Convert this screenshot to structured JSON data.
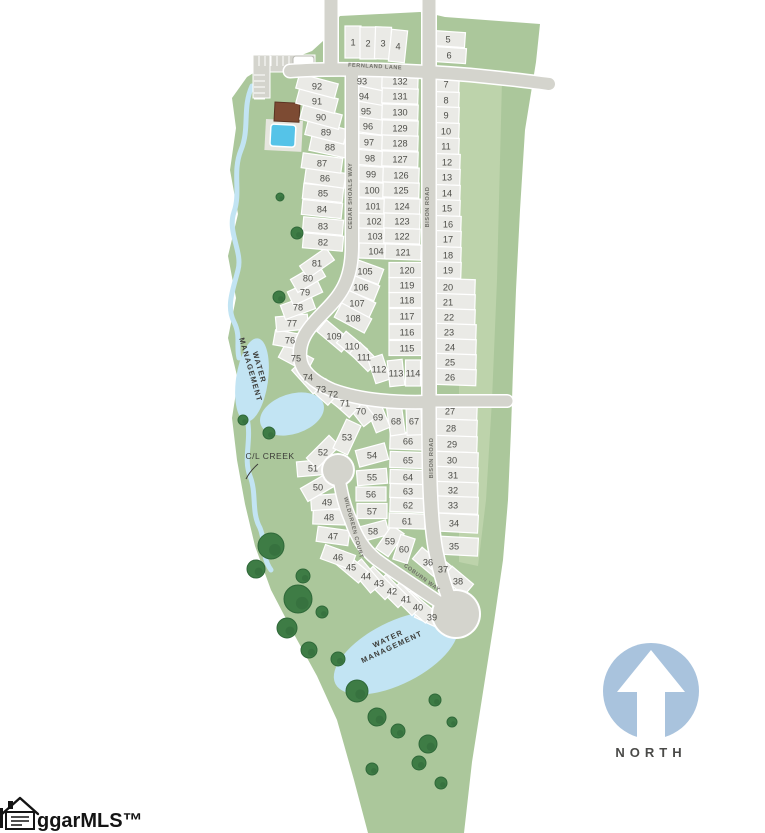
{
  "north": {
    "label": "NORTH"
  },
  "logo": {
    "text": "ggarMLS™"
  },
  "colors": {
    "green": "#abc79b",
    "greenLight": "#bdd3ab",
    "road": "#d4d4cd",
    "lot": "#eaeae6",
    "water": "#c2e4f3",
    "pool": "#55c3e8",
    "tree": "#3e7c45",
    "treeEdge": "#2f6839",
    "northBlue": "#a9c3dd",
    "numText": "#4d4d48",
    "labelText": "#6f6f68",
    "darkText": "#3c3c38",
    "roof": "#7d4b33",
    "deck": "#e6e6df"
  },
  "map": {
    "green_outline": [
      [
        340,
        16
      ],
      [
        420,
        12
      ],
      [
        432,
        14
      ],
      [
        445,
        17
      ],
      [
        540,
        24
      ],
      [
        536,
        62
      ],
      [
        525,
        130
      ],
      [
        520,
        210
      ],
      [
        516,
        290
      ],
      [
        513,
        370
      ],
      [
        511,
        430
      ],
      [
        508,
        500
      ],
      [
        503,
        560
      ],
      [
        494,
        622
      ],
      [
        483,
        692
      ],
      [
        472,
        762
      ],
      [
        464,
        833
      ],
      [
        368,
        833
      ],
      [
        354,
        780
      ],
      [
        337,
        720
      ],
      [
        317,
        676
      ],
      [
        295,
        636
      ],
      [
        271,
        590
      ],
      [
        255,
        546
      ],
      [
        245,
        504
      ],
      [
        237,
        460
      ],
      [
        232,
        418
      ],
      [
        238,
        380
      ],
      [
        228,
        338
      ],
      [
        236,
        298
      ],
      [
        228,
        256
      ],
      [
        238,
        214
      ],
      [
        230,
        170
      ],
      [
        236,
        128
      ],
      [
        232,
        98
      ],
      [
        247,
        77
      ],
      [
        268,
        64
      ],
      [
        294,
        58
      ],
      [
        312,
        51
      ],
      [
        323,
        41
      ],
      [
        331,
        27
      ]
    ],
    "green_light_strip": [
      [
        459,
        76
      ],
      [
        502,
        80
      ],
      [
        497,
        280
      ],
      [
        492,
        400
      ],
      [
        486,
        500
      ],
      [
        478,
        566
      ],
      [
        459,
        562
      ]
    ],
    "creek_paths": [
      "M252,86 C242,108 250,128 241,150 C232,172 241,192 234,212 C227,232 243,252 238,270 C233,290 226,306 234,322 C241,336 236,346 239,358",
      "M247,418 C252,440 243,458 250,476 C257,494 251,512 260,528 C266,542 261,556 271,570"
    ],
    "creek_label": {
      "text": "C/L CREEK",
      "x": 270,
      "y": 459,
      "leader": "M258,464 Q250,471 246,479"
    },
    "ponds": [
      {
        "cx": 252,
        "cy": 380,
        "rx": 16,
        "ry": 42,
        "rot": 8
      },
      {
        "cx": 292,
        "cy": 414,
        "rx": 33,
        "ry": 20,
        "rot": -18
      },
      {
        "cx": 396,
        "cy": 653,
        "rx": 68,
        "ry": 31,
        "rot": -27
      }
    ],
    "water_labels": [
      {
        "lines": [
          "WATER",
          "MANAGEMENT"
        ],
        "x": 257,
        "y": 368,
        "r": 74
      },
      {
        "lines": [
          "WATER",
          "MANAGEMENT"
        ],
        "x": 389,
        "y": 641,
        "r": -25
      }
    ],
    "roads": [
      {
        "name": "entry-north",
        "path": "M331,0 L331,68",
        "w": 13
      },
      {
        "name": "fernland-lane",
        "path": "M290,71 C340,67 420,71 470,75 C500,78 528,81 549,84",
        "w": 12
      },
      {
        "name": "bison-road",
        "path": "M429,0 L429,401",
        "w": 13
      },
      {
        "name": "bison-road-south",
        "path": "M429,401 C429,470 430,522 436,552 C441,576 446,592 451,602",
        "w": 13
      },
      {
        "name": "east-stub",
        "path": "M430,401 L507,401",
        "w": 11
      },
      {
        "name": "cedar-shoals-way",
        "path": "M352,74 L352,246 C352,282 340,296 322,314 C305,331 299,342 300,357 C301,371 312,381 332,390 C362,401 396,403 429,402",
        "w": 12
      },
      {
        "name": "wildgreen-court",
        "path": "M338,470 C341,494 345,507 351,521 C357,538 364,549 376,559 C392,571 414,585 436,600 C443,605 449,609 452,612",
        "w": 11
      }
    ],
    "culdesacs": [
      {
        "cx": 338,
        "cy": 470,
        "r": 15
      },
      {
        "cx": 456,
        "cy": 614,
        "r": 23
      }
    ],
    "street_labels": [
      {
        "text": "FERNLAND LANE",
        "x": 375,
        "y": 68,
        "r": 3
      },
      {
        "text": "CEDAR SHOALS WAY",
        "x": 352,
        "y": 196,
        "r": -90
      },
      {
        "text": "BISON ROAD",
        "x": 429,
        "y": 207,
        "r": -90
      },
      {
        "text": "BISON ROAD",
        "x": 433,
        "y": 458,
        "r": -90
      },
      {
        "text": "WILDGREEN COURT",
        "x": 352,
        "y": 528,
        "r": 75
      },
      {
        "text": "COBURN WAY",
        "x": 421,
        "y": 579,
        "r": 36
      }
    ],
    "amenity": {
      "parking": {
        "x": 253,
        "y": 55,
        "wTop": 62,
        "hTop": 17,
        "wSide": 17,
        "hSide": 43
      },
      "sign": {
        "x": 293,
        "y": 56,
        "w": 21,
        "h": 10
      },
      "clubhouse": {
        "x": 275,
        "y": 102,
        "w": 25,
        "h": 19
      },
      "pool_deck": {
        "x": 266,
        "y": 119,
        "w": 37,
        "h": 31
      },
      "pool": {
        "x": 271,
        "y": 124,
        "w": 25,
        "h": 22
      }
    },
    "trees": [
      [
        297,
        233,
        6
      ],
      [
        279,
        297,
        6
      ],
      [
        243,
        420,
        5
      ],
      [
        269,
        433,
        6
      ],
      [
        280,
        197,
        4
      ],
      [
        271,
        546,
        13
      ],
      [
        256,
        569,
        9
      ],
      [
        298,
        599,
        14
      ],
      [
        287,
        628,
        10
      ],
      [
        309,
        650,
        8
      ],
      [
        338,
        659,
        7
      ],
      [
        357,
        691,
        11
      ],
      [
        377,
        717,
        9
      ],
      [
        398,
        731,
        7
      ],
      [
        428,
        744,
        9
      ],
      [
        419,
        763,
        7
      ],
      [
        435,
        700,
        6
      ],
      [
        452,
        722,
        5
      ],
      [
        441,
        783,
        6
      ],
      [
        372,
        769,
        6
      ],
      [
        303,
        576,
        7
      ],
      [
        322,
        612,
        6
      ]
    ],
    "lots": [
      [
        1,
        353,
        42,
        16,
        32,
        0
      ],
      [
        2,
        368,
        43,
        16,
        32,
        0
      ],
      [
        3,
        383,
        43,
        16,
        32,
        2
      ],
      [
        4,
        398,
        46,
        16,
        32,
        6
      ],
      [
        5,
        448,
        39,
        34,
        15,
        4
      ],
      [
        6,
        449,
        55,
        34,
        15,
        4
      ],
      [
        7,
        446,
        84,
        26,
        16,
        2
      ],
      [
        8,
        446,
        100,
        26,
        16,
        2
      ],
      [
        9,
        446,
        115,
        26,
        16,
        2
      ],
      [
        10,
        446,
        131,
        26,
        16,
        2
      ],
      [
        11,
        446,
        146,
        26,
        16,
        2
      ],
      [
        12,
        447,
        162,
        26,
        16,
        2
      ],
      [
        13,
        447,
        177,
        26,
        16,
        2
      ],
      [
        14,
        447,
        193,
        26,
        16,
        2
      ],
      [
        15,
        447,
        208,
        26,
        16,
        2
      ],
      [
        16,
        448,
        224,
        26,
        16,
        2
      ],
      [
        17,
        448,
        239,
        26,
        16,
        2
      ],
      [
        18,
        448,
        255,
        26,
        16,
        2
      ],
      [
        19,
        448,
        270,
        26,
        16,
        2
      ],
      [
        20,
        448,
        287,
        42,
        16,
        2,
        454
      ],
      [
        21,
        448,
        302,
        42,
        16,
        2,
        454
      ],
      [
        22,
        449,
        317,
        42,
        16,
        2,
        454
      ],
      [
        23,
        449,
        332,
        42,
        16,
        2,
        455
      ],
      [
        24,
        450,
        347,
        42,
        16,
        2,
        455
      ],
      [
        25,
        450,
        362,
        42,
        16,
        2,
        455
      ],
      [
        26,
        450,
        377,
        42,
        16,
        2,
        455
      ],
      [
        27,
        450,
        411,
        44,
        17,
        2,
        455
      ],
      [
        28,
        451,
        428,
        44,
        17,
        2,
        455
      ],
      [
        29,
        452,
        444,
        44,
        16,
        2,
        455
      ],
      [
        30,
        452,
        460,
        44,
        16,
        2,
        456
      ],
      [
        31,
        453,
        475,
        44,
        16,
        2,
        456
      ],
      [
        32,
        453,
        490,
        44,
        16,
        2,
        456
      ],
      [
        33,
        453,
        505,
        44,
        17,
        2,
        456
      ],
      [
        34,
        454,
        523,
        44,
        18,
        3,
        456
      ],
      [
        35,
        454,
        546,
        44,
        18,
        3,
        456
      ],
      [
        36,
        428,
        562,
        28,
        15,
        40
      ],
      [
        37,
        443,
        569,
        28,
        15,
        40
      ],
      [
        38,
        458,
        581,
        28,
        15,
        40
      ],
      [
        39,
        432,
        617,
        32,
        15,
        25
      ],
      [
        40,
        418,
        607,
        32,
        15,
        40
      ],
      [
        41,
        406,
        599,
        32,
        15,
        45
      ],
      [
        42,
        392,
        591,
        32,
        15,
        45
      ],
      [
        43,
        379,
        583,
        32,
        15,
        45
      ],
      [
        44,
        366,
        576,
        32,
        15,
        50
      ],
      [
        45,
        351,
        567,
        32,
        15,
        40
      ],
      [
        46,
        338,
        557,
        32,
        15,
        20
      ],
      [
        47,
        333,
        536,
        32,
        15,
        8
      ],
      [
        48,
        329,
        517,
        32,
        15,
        2
      ],
      [
        49,
        327,
        502,
        32,
        15,
        -4
      ],
      [
        50,
        318,
        487,
        32,
        15,
        -30
      ],
      [
        51,
        313,
        468,
        32,
        15,
        -5
      ],
      [
        52,
        323,
        452,
        32,
        15,
        -45
      ],
      [
        53,
        347,
        437,
        32,
        16,
        -65
      ],
      [
        54,
        372,
        455,
        30,
        17,
        -15
      ],
      [
        55,
        372,
        477,
        30,
        15,
        -5
      ],
      [
        56,
        371,
        494,
        30,
        14,
        0
      ],
      [
        57,
        372,
        511,
        30,
        15,
        0
      ],
      [
        58,
        373,
        531,
        30,
        15,
        -15
      ],
      [
        59,
        390,
        541,
        28,
        15,
        -55
      ],
      [
        60,
        404,
        549,
        26,
        15,
        -72
      ],
      [
        61,
        407,
        521,
        36,
        15,
        2
      ],
      [
        62,
        408,
        505,
        36,
        14,
        2
      ],
      [
        63,
        408,
        491,
        36,
        14,
        2
      ],
      [
        64,
        408,
        477,
        36,
        14,
        2
      ],
      [
        65,
        408,
        460,
        36,
        16,
        2
      ],
      [
        66,
        408,
        441,
        36,
        17,
        2
      ],
      [
        67,
        414,
        421,
        15,
        28,
        -2
      ],
      [
        68,
        396,
        421,
        15,
        28,
        -8
      ],
      [
        69,
        378,
        417,
        15,
        28,
        -22
      ],
      [
        70,
        361,
        411,
        15,
        28,
        -38
      ],
      [
        71,
        345,
        403,
        16,
        26,
        -48
      ],
      [
        72,
        333,
        394,
        30,
        15,
        38
      ],
      [
        73,
        321,
        389,
        32,
        15,
        42
      ],
      [
        74,
        308,
        377,
        32,
        15,
        48
      ],
      [
        75,
        296,
        358,
        32,
        15,
        28
      ],
      [
        76,
        290,
        340,
        32,
        15,
        10
      ],
      [
        77,
        292,
        323,
        32,
        15,
        -5
      ],
      [
        78,
        298,
        307,
        32,
        15,
        -20
      ],
      [
        79,
        305,
        292,
        32,
        15,
        -25
      ],
      [
        80,
        308,
        278,
        32,
        15,
        -30
      ],
      [
        81,
        317,
        263,
        32,
        15,
        -35
      ],
      [
        82,
        323,
        242,
        40,
        15,
        5
      ],
      [
        83,
        323,
        226,
        40,
        15,
        5
      ],
      [
        84,
        322,
        209,
        40,
        15,
        6
      ],
      [
        85,
        323,
        193,
        40,
        15,
        6
      ],
      [
        86,
        325,
        178,
        40,
        15,
        8
      ],
      [
        87,
        322,
        163,
        40,
        15,
        8
      ],
      [
        88,
        330,
        147,
        40,
        15,
        12
      ],
      [
        89,
        326,
        132,
        40,
        15,
        14
      ],
      [
        90,
        321,
        117,
        40,
        15,
        15
      ],
      [
        91,
        317,
        101,
        40,
        15,
        15
      ],
      [
        92,
        317,
        86,
        40,
        15,
        15
      ],
      [
        93,
        362,
        81,
        28,
        15,
        14,
        371
      ],
      [
        94,
        364,
        96,
        28,
        15,
        12,
        371
      ],
      [
        95,
        366,
        111,
        28,
        15,
        10,
        371
      ],
      [
        96,
        368,
        126,
        28,
        15,
        8,
        371
      ],
      [
        97,
        369,
        142,
        28,
        15,
        6,
        371
      ],
      [
        98,
        370,
        158,
        28,
        15,
        5,
        371
      ],
      [
        99,
        371,
        174,
        28,
        15,
        4,
        371
      ],
      [
        100,
        372,
        190,
        28,
        15,
        3,
        371
      ],
      [
        101,
        373,
        206,
        28,
        15,
        3,
        372
      ],
      [
        102,
        374,
        221,
        28,
        15,
        2,
        372
      ],
      [
        103,
        375,
        236,
        28,
        15,
        2,
        372
      ],
      [
        104,
        376,
        251,
        28,
        15,
        2,
        373
      ],
      [
        105,
        365,
        271,
        34,
        16,
        20
      ],
      [
        106,
        361,
        287,
        34,
        16,
        22
      ],
      [
        107,
        357,
        303,
        34,
        16,
        25
      ],
      [
        108,
        353,
        318,
        34,
        16,
        28
      ],
      [
        109,
        334,
        336,
        32,
        15,
        40
      ],
      [
        110,
        352,
        346,
        28,
        15,
        40
      ],
      [
        111,
        364,
        357,
        26,
        15,
        45
      ],
      [
        112,
        379,
        369,
        15,
        26,
        -18
      ],
      [
        113,
        396,
        373,
        15,
        26,
        -6
      ],
      [
        114,
        413,
        373,
        15,
        26,
        0
      ],
      [
        115,
        407,
        348,
        36,
        15,
        0
      ],
      [
        116,
        407,
        332,
        36,
        15,
        0
      ],
      [
        117,
        407,
        316,
        36,
        15,
        0
      ],
      [
        118,
        407,
        300,
        36,
        15,
        0
      ],
      [
        119,
        407,
        285,
        36,
        15,
        0
      ],
      [
        120,
        407,
        270,
        36,
        15,
        0
      ],
      [
        121,
        403,
        252,
        36,
        15,
        2
      ],
      [
        122,
        402,
        236,
        36,
        15,
        2
      ],
      [
        123,
        402,
        221,
        36,
        15,
        2
      ],
      [
        124,
        402,
        206,
        36,
        15,
        2
      ],
      [
        125,
        401,
        190,
        36,
        15,
        2
      ],
      [
        126,
        401,
        175,
        36,
        15,
        2
      ],
      [
        127,
        400,
        159,
        36,
        15,
        2
      ],
      [
        128,
        400,
        143,
        36,
        15,
        2
      ],
      [
        129,
        400,
        128,
        36,
        15,
        2
      ],
      [
        130,
        400,
        112,
        36,
        15,
        2
      ],
      [
        131,
        400,
        96,
        36,
        15,
        2
      ],
      [
        132,
        400,
        81,
        36,
        15,
        2
      ]
    ]
  }
}
